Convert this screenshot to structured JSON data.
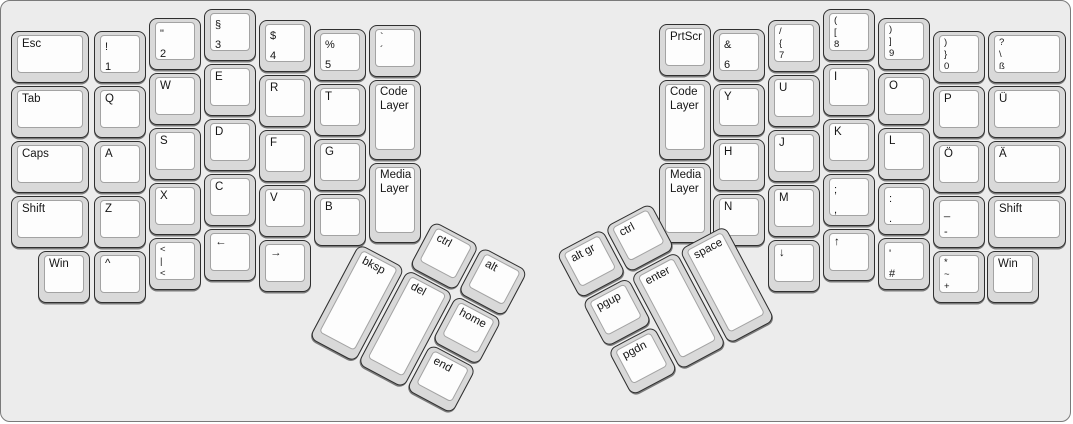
{
  "board": {
    "background": "#ececec",
    "border_color": "#7a7a7a",
    "key_base_color": "#d9d9d9",
    "key_top_color": "#fdfdfd",
    "key_border_color": "#2f2f2f",
    "legend_color": "#161616"
  },
  "left_main": [
    {
      "name": "esc",
      "x": 10,
      "y": 30,
      "w": 78,
      "lines": [
        "Esc"
      ]
    },
    {
      "name": "tab",
      "x": 10,
      "y": 85,
      "w": 78,
      "lines": [
        "Tab"
      ]
    },
    {
      "name": "caps",
      "x": 10,
      "y": 140,
      "w": 78,
      "lines": [
        "Caps"
      ]
    },
    {
      "name": "shift-left",
      "x": 10,
      "y": 195,
      "w": 78,
      "lines": [
        "Shift"
      ]
    },
    {
      "name": "1-exclam",
      "x": 93,
      "y": 30,
      "lines": [
        "!",
        "1"
      ],
      "cls": "n2"
    },
    {
      "name": "q",
      "x": 93,
      "y": 85,
      "lines": [
        "Q"
      ]
    },
    {
      "name": "a",
      "x": 93,
      "y": 140,
      "lines": [
        "A"
      ]
    },
    {
      "name": "z",
      "x": 93,
      "y": 195,
      "lines": [
        "Z"
      ]
    },
    {
      "name": "caret",
      "x": 93,
      "y": 250,
      "lines": [
        "^"
      ]
    },
    {
      "name": "2-quote",
      "x": 148,
      "y": 17,
      "lines": [
        "\"",
        "2"
      ],
      "cls": "n2"
    },
    {
      "name": "w",
      "x": 148,
      "y": 72,
      "lines": [
        "W"
      ]
    },
    {
      "name": "s",
      "x": 148,
      "y": 127,
      "lines": [
        "S"
      ]
    },
    {
      "name": "x",
      "x": 148,
      "y": 182,
      "lines": [
        "X"
      ]
    },
    {
      "name": "angle-pipe",
      "x": 148,
      "y": 237,
      "lines": [
        "<",
        "|",
        "<"
      ],
      "cls": "n3"
    },
    {
      "name": "3-paragraph",
      "x": 203,
      "y": 8,
      "lines": [
        "§",
        "3"
      ],
      "cls": "n2"
    },
    {
      "name": "e",
      "x": 203,
      "y": 63,
      "lines": [
        "E"
      ]
    },
    {
      "name": "d",
      "x": 203,
      "y": 118,
      "lines": [
        "D"
      ]
    },
    {
      "name": "c",
      "x": 203,
      "y": 173,
      "lines": [
        "C"
      ]
    },
    {
      "name": "arrow-left",
      "x": 203,
      "y": 228,
      "lines": [
        "←"
      ]
    },
    {
      "name": "4-dollar",
      "x": 258,
      "y": 19,
      "lines": [
        "$",
        "4"
      ],
      "cls": "n2"
    },
    {
      "name": "r",
      "x": 258,
      "y": 74,
      "lines": [
        "R"
      ]
    },
    {
      "name": "f",
      "x": 258,
      "y": 129,
      "lines": [
        "F"
      ]
    },
    {
      "name": "v",
      "x": 258,
      "y": 184,
      "lines": [
        "V"
      ]
    },
    {
      "name": "arrow-right",
      "x": 258,
      "y": 239,
      "lines": [
        "→"
      ]
    },
    {
      "name": "5-percent",
      "x": 313,
      "y": 28,
      "lines": [
        "%",
        "5"
      ],
      "cls": "n2"
    },
    {
      "name": "t",
      "x": 313,
      "y": 83,
      "lines": [
        "T"
      ]
    },
    {
      "name": "g",
      "x": 313,
      "y": 138,
      "lines": [
        "G"
      ]
    },
    {
      "name": "b",
      "x": 313,
      "y": 193,
      "lines": [
        "B"
      ]
    },
    {
      "name": "grave-acute",
      "x": 368,
      "y": 24,
      "lines": [
        "`",
        "´"
      ],
      "cls": "t2"
    },
    {
      "name": "code-layer-left",
      "x": 368,
      "y": 79,
      "h": 80,
      "lines": [
        "Code",
        "Layer"
      ],
      "cls": "layer"
    },
    {
      "name": "media-layer-left",
      "x": 368,
      "y": 162,
      "h": 80,
      "lines": [
        "Media",
        "Layer"
      ],
      "cls": "layer"
    },
    {
      "name": "win-left",
      "x": 37,
      "y": 250,
      "lines": [
        "Win"
      ]
    }
  ],
  "right_main": [
    {
      "name": "prtscr",
      "x": 658,
      "y": 23,
      "lines": [
        "PrtScr"
      ]
    },
    {
      "name": "code-layer-right",
      "x": 658,
      "y": 79,
      "h": 80,
      "lines": [
        "Code",
        "Layer"
      ],
      "cls": "layer"
    },
    {
      "name": "media-layer-right",
      "x": 658,
      "y": 162,
      "h": 80,
      "lines": [
        "Media",
        "Layer"
      ],
      "cls": "layer"
    },
    {
      "name": "6-ampersand",
      "x": 712,
      "y": 28,
      "lines": [
        "&",
        "6"
      ],
      "cls": "n2"
    },
    {
      "name": "y",
      "x": 712,
      "y": 83,
      "lines": [
        "Y"
      ]
    },
    {
      "name": "h",
      "x": 712,
      "y": 138,
      "lines": [
        "H"
      ]
    },
    {
      "name": "n",
      "x": 712,
      "y": 193,
      "lines": [
        "N"
      ]
    },
    {
      "name": "7-slash-brace",
      "x": 767,
      "y": 19,
      "lines": [
        "/",
        "{",
        "7"
      ],
      "cls": "n3"
    },
    {
      "name": "u",
      "x": 767,
      "y": 74,
      "lines": [
        "U"
      ]
    },
    {
      "name": "j",
      "x": 767,
      "y": 129,
      "lines": [
        "J"
      ]
    },
    {
      "name": "m",
      "x": 767,
      "y": 184,
      "lines": [
        "M"
      ]
    },
    {
      "name": "arrow-down",
      "x": 767,
      "y": 239,
      "lines": [
        "↓"
      ]
    },
    {
      "name": "8-paren-bracket",
      "x": 822,
      "y": 8,
      "lines": [
        "(",
        "[",
        "8"
      ],
      "cls": "n3"
    },
    {
      "name": "i",
      "x": 822,
      "y": 63,
      "lines": [
        "I"
      ]
    },
    {
      "name": "k",
      "x": 822,
      "y": 118,
      "lines": [
        "K"
      ]
    },
    {
      "name": "semicolon-comma",
      "x": 822,
      "y": 173,
      "lines": [
        ";",
        ","
      ],
      "cls": "n2"
    },
    {
      "name": "arrow-up",
      "x": 822,
      "y": 228,
      "lines": [
        "↑"
      ]
    },
    {
      "name": "9-paren-bracket",
      "x": 877,
      "y": 17,
      "lines": [
        ")",
        "]",
        "9"
      ],
      "cls": "n3"
    },
    {
      "name": "o",
      "x": 877,
      "y": 72,
      "lines": [
        "O"
      ]
    },
    {
      "name": "l",
      "x": 877,
      "y": 127,
      "lines": [
        "L"
      ]
    },
    {
      "name": "colon-period",
      "x": 877,
      "y": 182,
      "lines": [
        ":",
        "."
      ],
      "cls": "n2"
    },
    {
      "name": "apostrophe-hash",
      "x": 877,
      "y": 237,
      "lines": [
        "'",
        "#"
      ],
      "cls": "n2"
    },
    {
      "name": "0-paren-brace",
      "x": 932,
      "y": 30,
      "lines": [
        ")",
        "}",
        "0"
      ],
      "cls": "n3"
    },
    {
      "name": "p",
      "x": 932,
      "y": 85,
      "lines": [
        "P"
      ]
    },
    {
      "name": "o-umlaut",
      "x": 932,
      "y": 140,
      "lines": [
        "Ö"
      ]
    },
    {
      "name": "underscore-dash",
      "x": 932,
      "y": 195,
      "lines": [
        "_",
        "-"
      ],
      "cls": "n2"
    },
    {
      "name": "asterisk-tilde-plus",
      "x": 932,
      "y": 250,
      "lines": [
        "*",
        "~",
        "+"
      ],
      "cls": "n3"
    },
    {
      "name": "eszett",
      "x": 987,
      "y": 30,
      "w": 78,
      "lines": [
        "?",
        "\\",
        "ß"
      ],
      "cls": "n3"
    },
    {
      "name": "u-umlaut",
      "x": 987,
      "y": 85,
      "w": 78,
      "lines": [
        "Ü"
      ]
    },
    {
      "name": "a-umlaut",
      "x": 987,
      "y": 140,
      "w": 78,
      "lines": [
        "Ä"
      ]
    },
    {
      "name": "shift-right",
      "x": 987,
      "y": 195,
      "w": 78,
      "lines": [
        "Shift"
      ]
    },
    {
      "name": "win-right",
      "x": 986,
      "y": 250,
      "lines": [
        "Win"
      ]
    }
  ],
  "left_thumb": {
    "x": 384,
    "y": 194,
    "rotation_deg": 28,
    "keys": [
      {
        "name": "ctrl-left",
        "x": 55,
        "y": 0,
        "lines": [
          "ctrl"
        ]
      },
      {
        "name": "alt",
        "x": 110,
        "y": 0,
        "lines": [
          "alt"
        ]
      },
      {
        "name": "bksp",
        "x": 0,
        "y": 55,
        "h": 107,
        "lines": [
          "bksp"
        ]
      },
      {
        "name": "del",
        "x": 55,
        "y": 55,
        "h": 107,
        "lines": [
          "del"
        ]
      },
      {
        "name": "home",
        "x": 110,
        "y": 55,
        "lines": [
          "home"
        ]
      },
      {
        "name": "end",
        "x": 110,
        "y": 110,
        "lines": [
          "end"
        ]
      }
    ]
  },
  "right_thumb": {
    "x": 555,
    "y": 252,
    "rotation_deg": -28,
    "keys": [
      {
        "name": "alt-gr",
        "x": 0,
        "y": 0,
        "lines": [
          "alt gr"
        ]
      },
      {
        "name": "ctrl-right",
        "x": 55,
        "y": 0,
        "lines": [
          "ctrl"
        ]
      },
      {
        "name": "pgup",
        "x": 0,
        "y": 55,
        "lines": [
          "pgup"
        ]
      },
      {
        "name": "pgdn",
        "x": 0,
        "y": 110,
        "lines": [
          "pgdn"
        ]
      },
      {
        "name": "enter",
        "x": 55,
        "y": 55,
        "h": 107,
        "lines": [
          "enter"
        ]
      },
      {
        "name": "space",
        "x": 110,
        "y": 55,
        "h": 107,
        "lines": [
          "space"
        ]
      }
    ]
  }
}
